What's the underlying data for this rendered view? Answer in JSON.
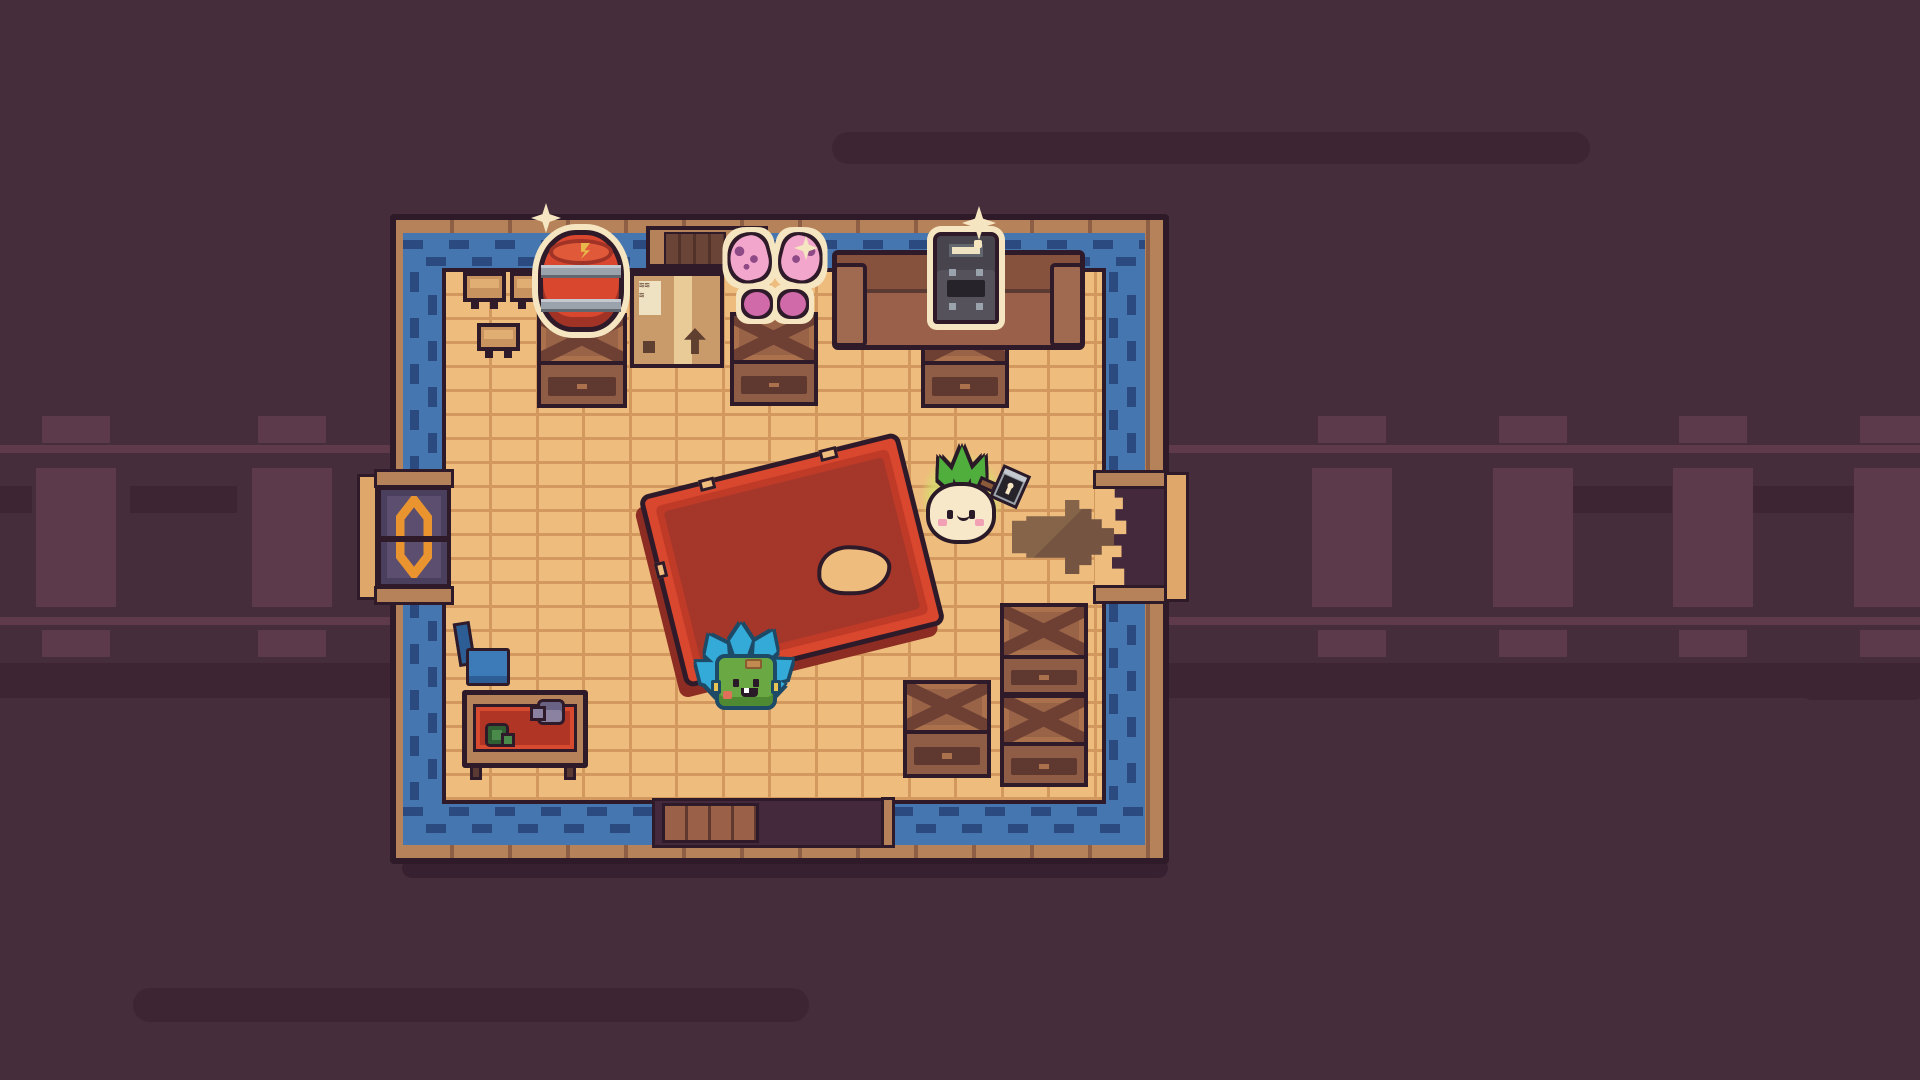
{
  "scene": {
    "title": "Cozy pixel-art train car interior with turnip villager"
  },
  "colors": {
    "bg": "#462d3c",
    "bgDark": "#3d2534",
    "tie": "#5d3a4b",
    "rail": "#5e3a4a",
    "shadow": "#372131",
    "outline": "#2e1a28",
    "outlineSoft": "#5a3a33",
    "ink": "#2a1a28",
    "wallWood": "#b5825a",
    "wallLine": "#8f5f45",
    "stepPlank": "#dfa76a",
    "carpet": "#4676b0",
    "carpetDash": "#2a4a80",
    "floor": "#eebc7d",
    "floorLine": "#d2985e",
    "voidDark": "#43293b",
    "platformWood": "#9a6048",
    "doorPanel": "#5b4e6e",
    "doorPanelDark": "#4a3f5c",
    "doorAccent": "#ea9430",
    "crateTop": "#996347",
    "crateHi": "#aa714c",
    "crateX": "#6e4034",
    "crateFront": "#8f5d45",
    "crateSlat": "#5f3830",
    "tableTan": "#c8935f",
    "tableTanHi": "#e0ad72",
    "couch": "#9a6049",
    "couchDark": "#86523e",
    "couchArm": "#a06a50",
    "cream": "#f5e5c0",
    "gold": "#e8b84a",
    "barrelRed": "#d9472e",
    "barrelDark": "#a03226",
    "barrelHi": "#e05a3a",
    "metal": "#9aa2ab",
    "metalHi": "#c3c9cf",
    "metalDark": "#62666f",
    "boxTan": "#c99b6b",
    "boxTape": "#e8cb96",
    "boxDark": "#5f4030",
    "labelCream": "#efe2c2",
    "stoveGray": "#56525c",
    "stoveTopGray": "#47444d",
    "stoveDark": "#26232a",
    "bflyPink": "#f2a6cb",
    "bflyDeep": "#d06aa8",
    "bflySpot": "#8e4a86",
    "matRed": "#b13524",
    "matRedBright": "#d84a30",
    "mugGreen": "#4a8a4a",
    "mugGreenDark": "#2f5f33",
    "kettle": "#8a82a0",
    "kettleDark": "#6a6284",
    "chairBlue": "#3c7ab8",
    "chairBlueDark": "#2c5d94",
    "tableRed": "#d9472e",
    "tableRedMid": "#c03a28",
    "tableRedDeep": "#a5372a",
    "tableRedDark": "#8c2c22",
    "arrowBrown": "#755541",
    "arrowHi": "#85644a",
    "creatureBlue": "#34aad8",
    "petalOutline": "#1d4a66",
    "creatureGreen": "#6aa844",
    "creatureGreenDark": "#4f8a33",
    "creatureYellow": "#e8c455",
    "creaturePatch": "#c08a50",
    "creaturePatchDark": "#8a5a30",
    "blushRed": "#e0705a",
    "blushPink": "#f2a0b4",
    "turnipCream": "#f6e8c8",
    "leafGreen": "#4fae3c",
    "glow": "#d6de6e",
    "handleBrown": "#8a5a3a",
    "darkPlank": "#6a4436",
    "darkPlankLine": "#523228"
  },
  "background": {
    "speed_lines": [
      {
        "x": 832,
        "y": 132,
        "w": 758,
        "h": 32
      },
      {
        "x": 133,
        "y": 988,
        "w": 676,
        "h": 34
      },
      {
        "x": 1798,
        "y": 670,
        "w": 130,
        "h": 30
      }
    ],
    "shadow_stripes": [
      {
        "x": 0,
        "y": 486,
        "w": 32,
        "h": 27
      },
      {
        "x": 130,
        "y": 486,
        "w": 107,
        "h": 27
      },
      {
        "x": 1572,
        "y": 486,
        "w": 100,
        "h": 27
      },
      {
        "x": 1752,
        "y": 486,
        "w": 168,
        "h": 27
      },
      {
        "x": 0,
        "y": 663,
        "w": 1920,
        "h": 35
      }
    ],
    "track": {
      "rail_ys": [
        445,
        617
      ],
      "tie_xs": [
        36,
        252,
        1312,
        1493,
        1673,
        1854
      ]
    }
  },
  "room": {
    "carpet_segments": [
      {
        "x": 403,
        "y": 233,
        "w": 742,
        "h": 39,
        "dir": "h"
      },
      {
        "x": 403,
        "y": 272,
        "w": 43,
        "h": 205,
        "dir": "v"
      },
      {
        "x": 403,
        "y": 598,
        "w": 43,
        "h": 247,
        "dir": "v"
      },
      {
        "x": 1102,
        "y": 272,
        "w": 43,
        "h": 200,
        "dir": "v"
      },
      {
        "x": 1102,
        "y": 602,
        "w": 43,
        "h": 243,
        "dir": "v"
      },
      {
        "x": 403,
        "y": 800,
        "w": 249,
        "h": 45,
        "dir": "h"
      },
      {
        "x": 893,
        "y": 800,
        "w": 252,
        "h": 45,
        "dir": "h"
      }
    ],
    "crates": [
      {
        "x": 537,
        "y": 313,
        "w": 90,
        "h": 95,
        "top": 48
      },
      {
        "x": 730,
        "y": 312,
        "w": 88,
        "h": 94,
        "top": 48
      },
      {
        "x": 921,
        "y": 313,
        "w": 88,
        "h": 95,
        "top": 48
      },
      {
        "x": 903,
        "y": 680,
        "w": 88,
        "h": 98,
        "top": 50
      },
      {
        "x": 1000,
        "y": 603,
        "w": 88,
        "h": 93,
        "top": 52
      },
      {
        "x": 1000,
        "y": 694,
        "w": 88,
        "h": 93,
        "top": 48
      }
    ],
    "small_tables": [
      {
        "x": 463,
        "y": 272,
        "w": 43,
        "h": 30
      },
      {
        "x": 510,
        "y": 272,
        "w": 43,
        "h": 30
      },
      {
        "x": 477,
        "y": 323,
        "w": 43,
        "h": 28
      }
    ]
  },
  "entities": {
    "room": "train car room",
    "track": "railway track",
    "speed_line": "motion line",
    "barrel": "red supply barrel (highlighted item)",
    "stove": "iron stove (highlighted item)",
    "butterfly": "butterfly wings (highlighted item)",
    "box": "cardboard shipping box",
    "cabinet": "wall shutter panel",
    "couch": "brown couch",
    "red_table": "large red table",
    "desk": "writing desk with mat, mug and kettle",
    "chair": "blue chair",
    "creature": "blue-leaf sprite",
    "player": "turnip villager holding lantern",
    "arrow": "exit arrow decal",
    "door_left": "west sliding door",
    "exit_right": "east broken-wall exit",
    "door_bottom": "south doorway step",
    "sparkle": "sparkle"
  }
}
